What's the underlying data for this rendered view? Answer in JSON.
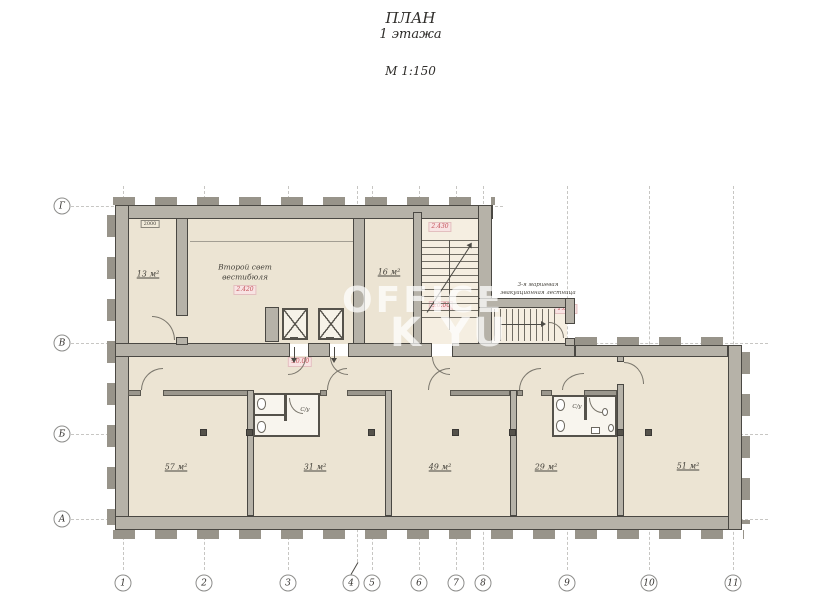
{
  "title": {
    "line1": "ПЛАН",
    "line2": "1  этажа",
    "scale": "М 1:150"
  },
  "watermark": {
    "line1": "OFFICE",
    "line2": "K YU"
  },
  "axes": {
    "columns": [
      {
        "label": "1"
      },
      {
        "label": "2"
      },
      {
        "label": "3"
      },
      {
        "label": "4"
      },
      {
        "label": "5"
      },
      {
        "label": "6"
      },
      {
        "label": "7"
      },
      {
        "label": "8"
      },
      {
        "label": "9"
      },
      {
        "label": "10"
      },
      {
        "label": "11"
      }
    ],
    "rows": [
      {
        "label": "Г"
      },
      {
        "label": "В"
      },
      {
        "label": "Б"
      },
      {
        "label": "А"
      }
    ]
  },
  "rooms": {
    "room13": "13 м²",
    "room16": "16 м²",
    "room57": "57 м²",
    "room31": "31 м²",
    "room49": "49 м²",
    "room29": "29 м²",
    "room51": "51 м²",
    "vestibule_line1": "Второй свет",
    "vestibule_line2": "вестибюля",
    "wc": "С/у"
  },
  "marks": {
    "vestibule": "2.420",
    "stair_top": "2.430",
    "stair_bottom": "±0.00",
    "evac_stair": "1.090",
    "lobby": "±0.00",
    "dim_top_left": "2000"
  },
  "annotations": {
    "evac_line1": "3-я маршевая",
    "evac_line2": "эвакуационная  лестница"
  },
  "colors": {
    "wall": "#b6b2a8",
    "room_fill": "#ece4d3",
    "accent_red": "#c4535a"
  }
}
